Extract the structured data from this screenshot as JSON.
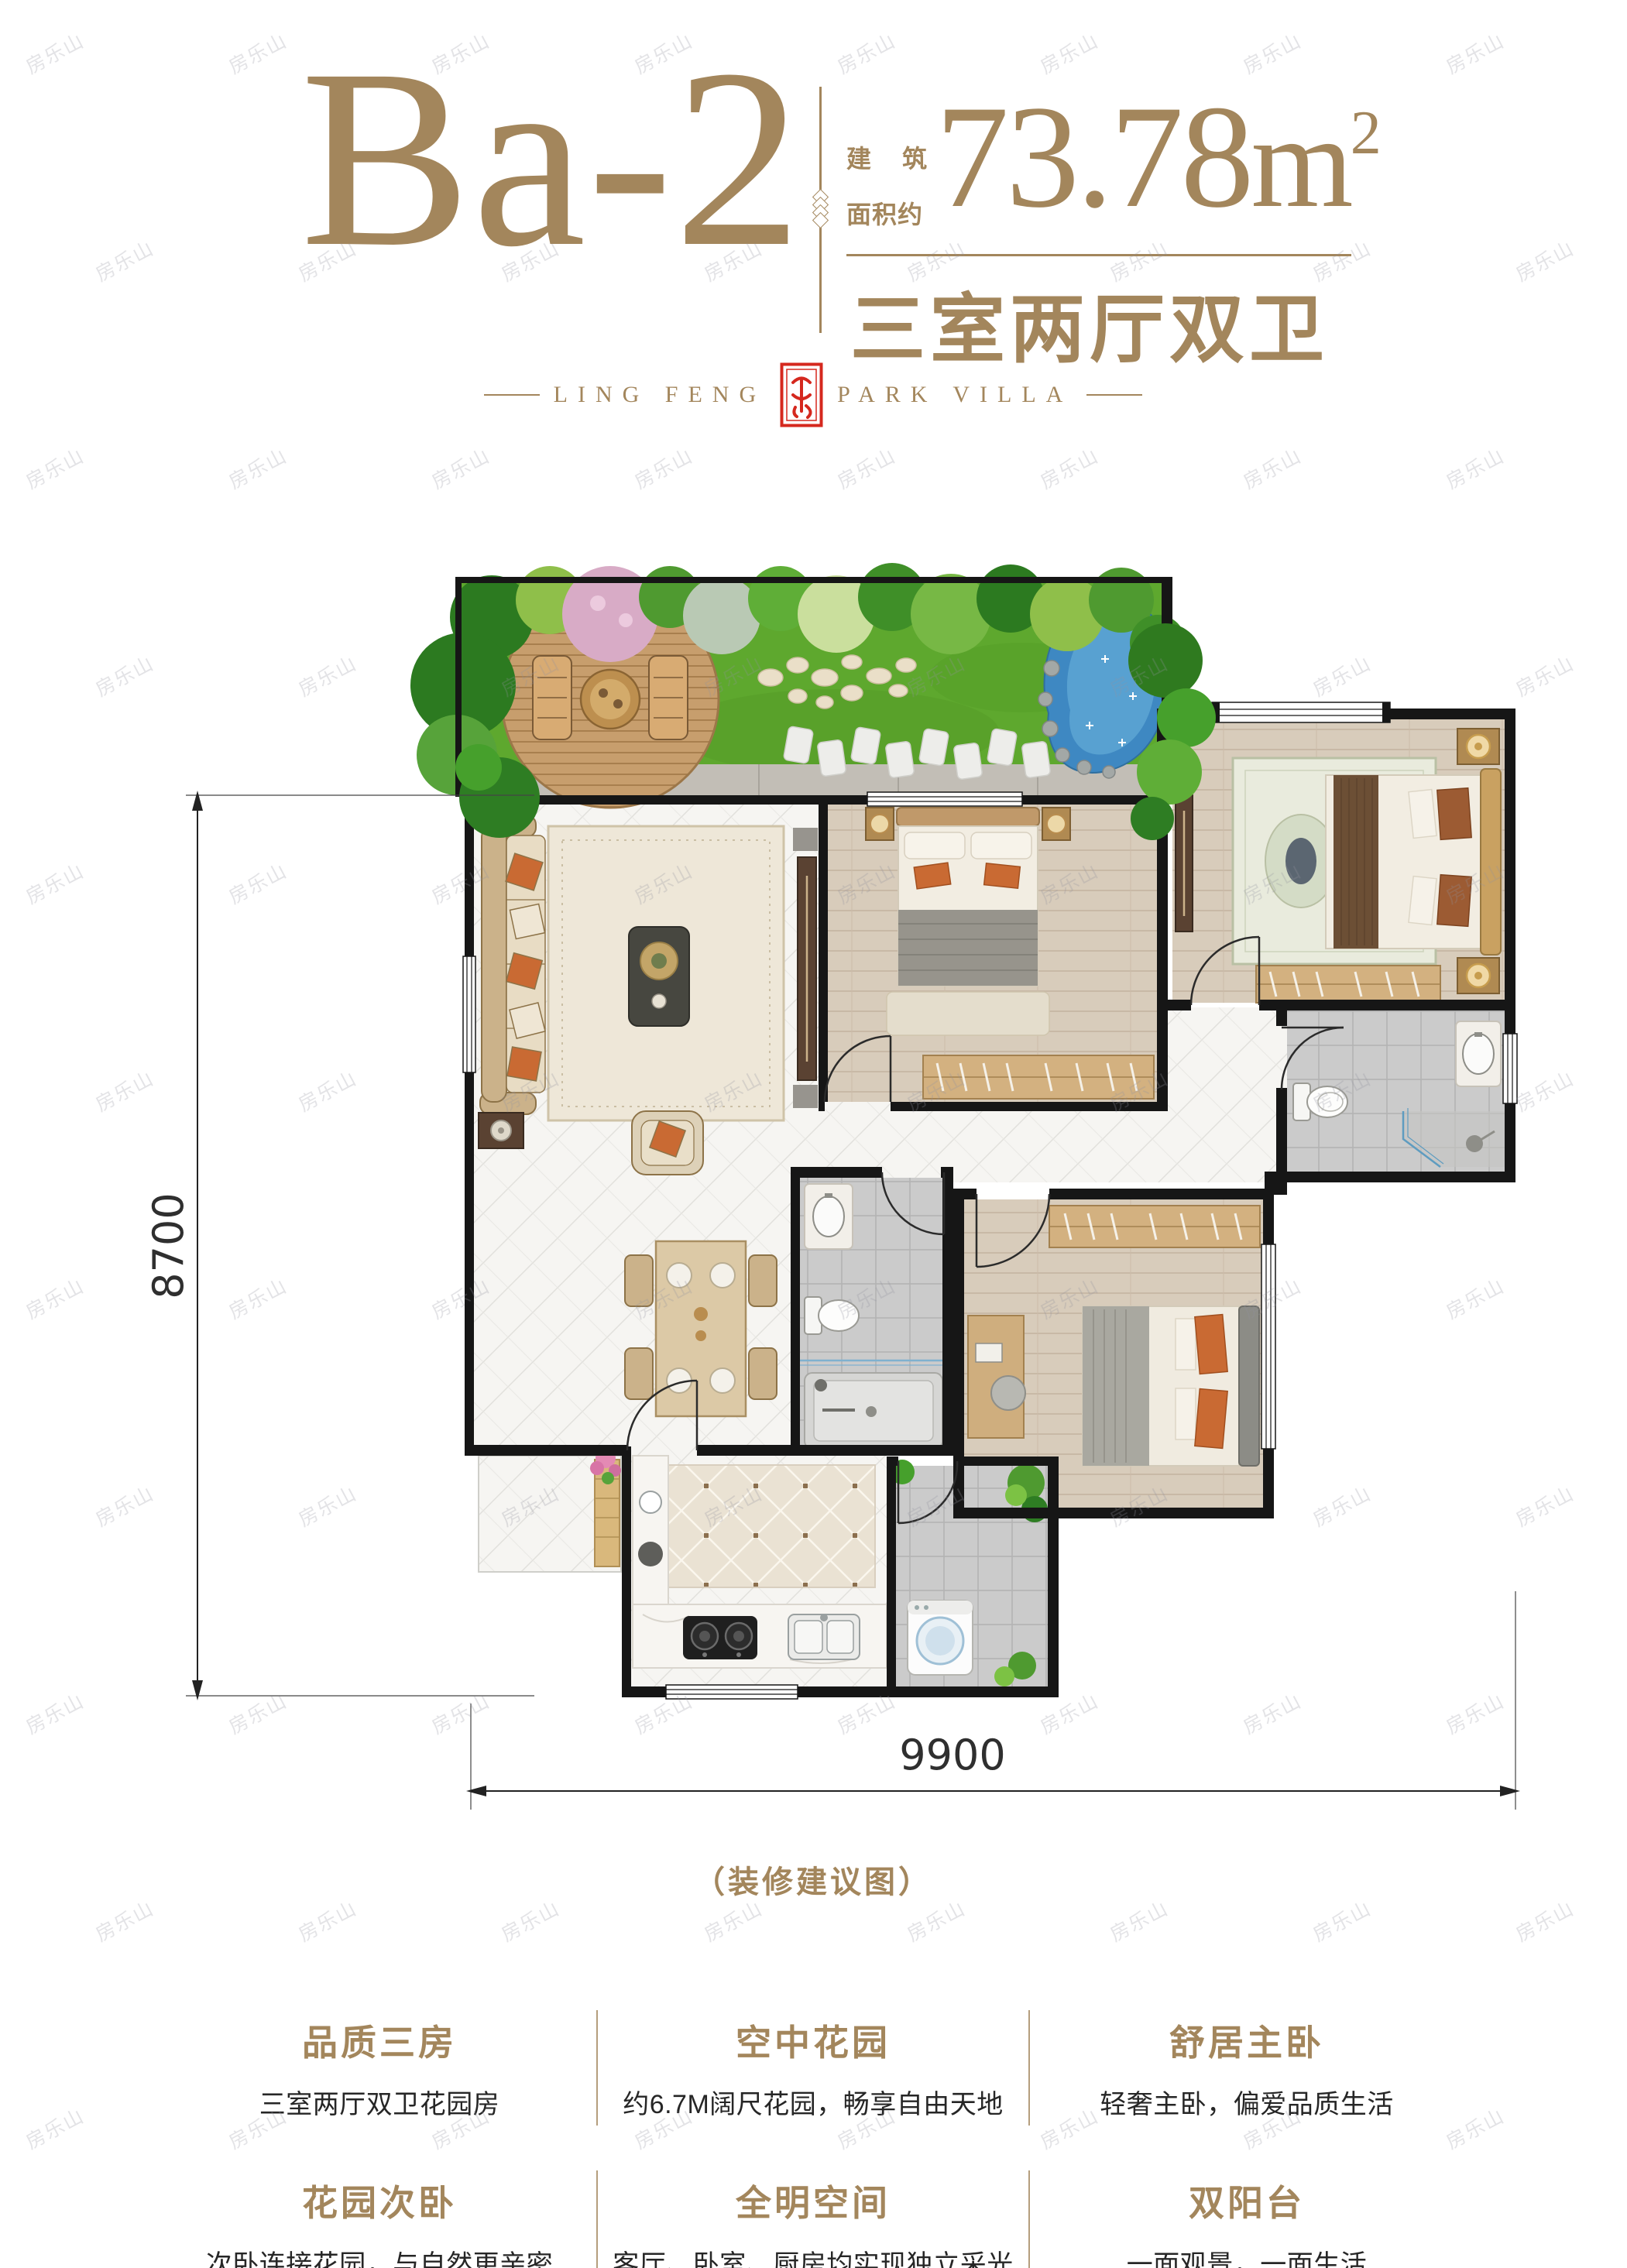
{
  "watermark": {
    "text": "房乐山"
  },
  "header": {
    "unit_code": "Ba-2",
    "area_label_line1_a": "建",
    "area_label_line1_b": "筑",
    "area_label_line2": "面积约",
    "area_value": "73.78",
    "area_unit": "m",
    "area_sup": "2",
    "layout_text": "三室两厅双卫"
  },
  "brand": {
    "left_text": "LING FENG",
    "right_text": "PARK VILLA",
    "seal_icon": "red-seal-stamp"
  },
  "floor_plan": {
    "dim_left": "8700",
    "dim_bottom": "9900",
    "caption": "（装修建议图）",
    "rooms": [
      "roof-garden",
      "living-dining-room",
      "bedroom-2",
      "master-bedroom",
      "master-bathroom",
      "bathroom",
      "bedroom-3",
      "kitchen",
      "service-balcony",
      "entry-porch"
    ]
  },
  "features": [
    {
      "title": "品质三房",
      "desc": "三室两厅双卫花园房"
    },
    {
      "title": "空中花园",
      "desc": "约6.7M阔尺花园，畅享自由天地"
    },
    {
      "title": "舒居主卧",
      "desc": "轻奢主卧，偏爱品质生活"
    },
    {
      "title": "花园次卧",
      "desc": "次卧连接花园，与自然更亲密"
    },
    {
      "title": "全明空间",
      "desc": "客厅、卧室、厨房均实现独立采光"
    },
    {
      "title": "双阳台",
      "desc": "一面观景，一面生活"
    }
  ],
  "colors": {
    "accent_gold": "#a3865c",
    "seal_red": "#d5281e",
    "text_dark": "#262626",
    "wall_black": "#161616",
    "lawn_green": "#5ea82e",
    "pond_blue": "#3e88c2",
    "wood_floor": "#d8ccbb",
    "marble_floor": "#f6f5f2",
    "tile_gray": "#cccccc"
  }
}
